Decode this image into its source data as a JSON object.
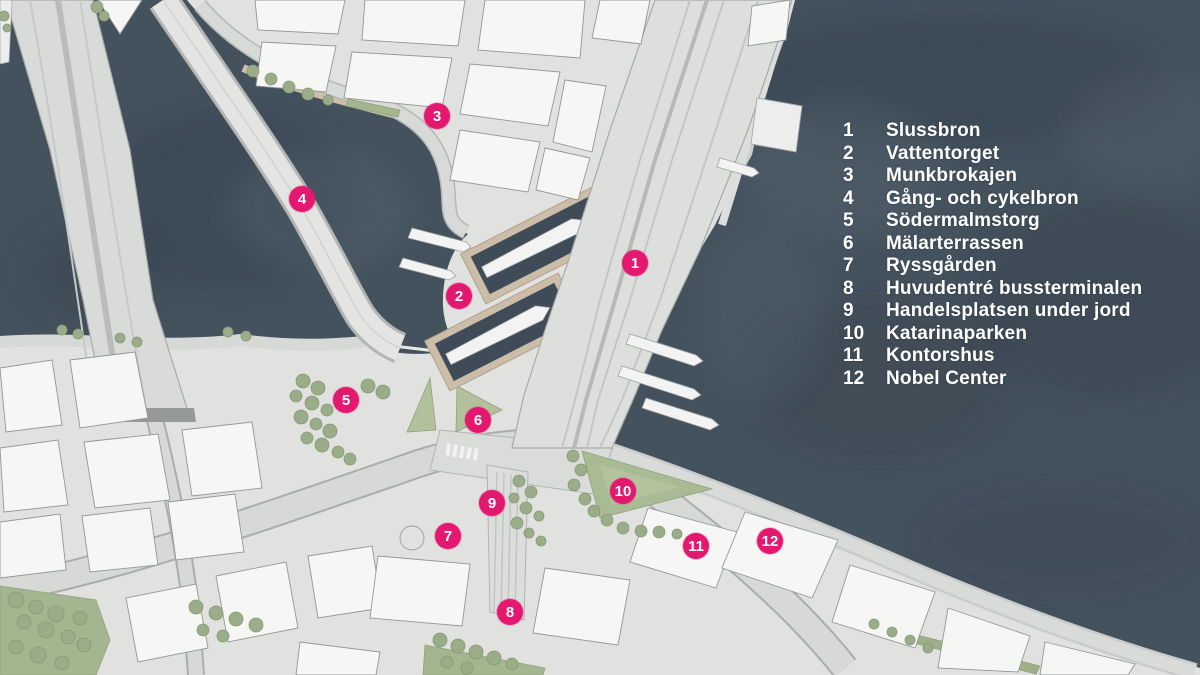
{
  "colors": {
    "marker_pink": "#e3186f",
    "water": "#44525e",
    "water_dark": "#39444e",
    "land": "#e1e2e0",
    "building": "#f6f7f5",
    "road": "#d6d8d6",
    "greenery": "#a5b792",
    "quay_tan": "#cdbfa9",
    "legend_text": "#ffffff"
  },
  "legend": {
    "items": [
      {
        "num": "1",
        "label": "Slussbron"
      },
      {
        "num": "2",
        "label": "Vattentorget"
      },
      {
        "num": "3",
        "label": "Munkbrokajen"
      },
      {
        "num": "4",
        "label": "Gång- och cykelbron"
      },
      {
        "num": "5",
        "label": "Södermalmstorg"
      },
      {
        "num": "6",
        "label": "Mälarterrassen"
      },
      {
        "num": "7",
        "label": "Ryssgården"
      },
      {
        "num": "8",
        "label": "Huvudentré bussterminalen"
      },
      {
        "num": "9",
        "label": "Handelsplatsen under jord"
      },
      {
        "num": "10",
        "label": "Katarinaparken"
      },
      {
        "num": "11",
        "label": "Kontorshus"
      },
      {
        "num": "12",
        "label": "Nobel Center"
      }
    ]
  },
  "markers": [
    {
      "num": "1",
      "label": "Slussbron",
      "x": 635,
      "y": 263
    },
    {
      "num": "2",
      "label": "Vattentorget",
      "x": 459,
      "y": 296
    },
    {
      "num": "3",
      "label": "Munkbrokajen",
      "x": 437,
      "y": 116
    },
    {
      "num": "4",
      "label": "Gång- och cykelbron",
      "x": 302,
      "y": 199
    },
    {
      "num": "5",
      "label": "Södermalmstorg",
      "x": 346,
      "y": 400
    },
    {
      "num": "6",
      "label": "Mälarterrassen",
      "x": 478,
      "y": 420
    },
    {
      "num": "7",
      "label": "Ryssgården",
      "x": 448,
      "y": 536
    },
    {
      "num": "8",
      "label": "Huvudentré bussterminalen",
      "x": 510,
      "y": 612
    },
    {
      "num": "9",
      "label": "Handelsplatsen under jord",
      "x": 492,
      "y": 503
    },
    {
      "num": "10",
      "label": "Katarinaparken",
      "x": 623,
      "y": 491
    },
    {
      "num": "11",
      "label": "Kontorshus",
      "x": 696,
      "y": 546
    },
    {
      "num": "12",
      "label": "Nobel Center",
      "x": 770,
      "y": 541
    }
  ]
}
